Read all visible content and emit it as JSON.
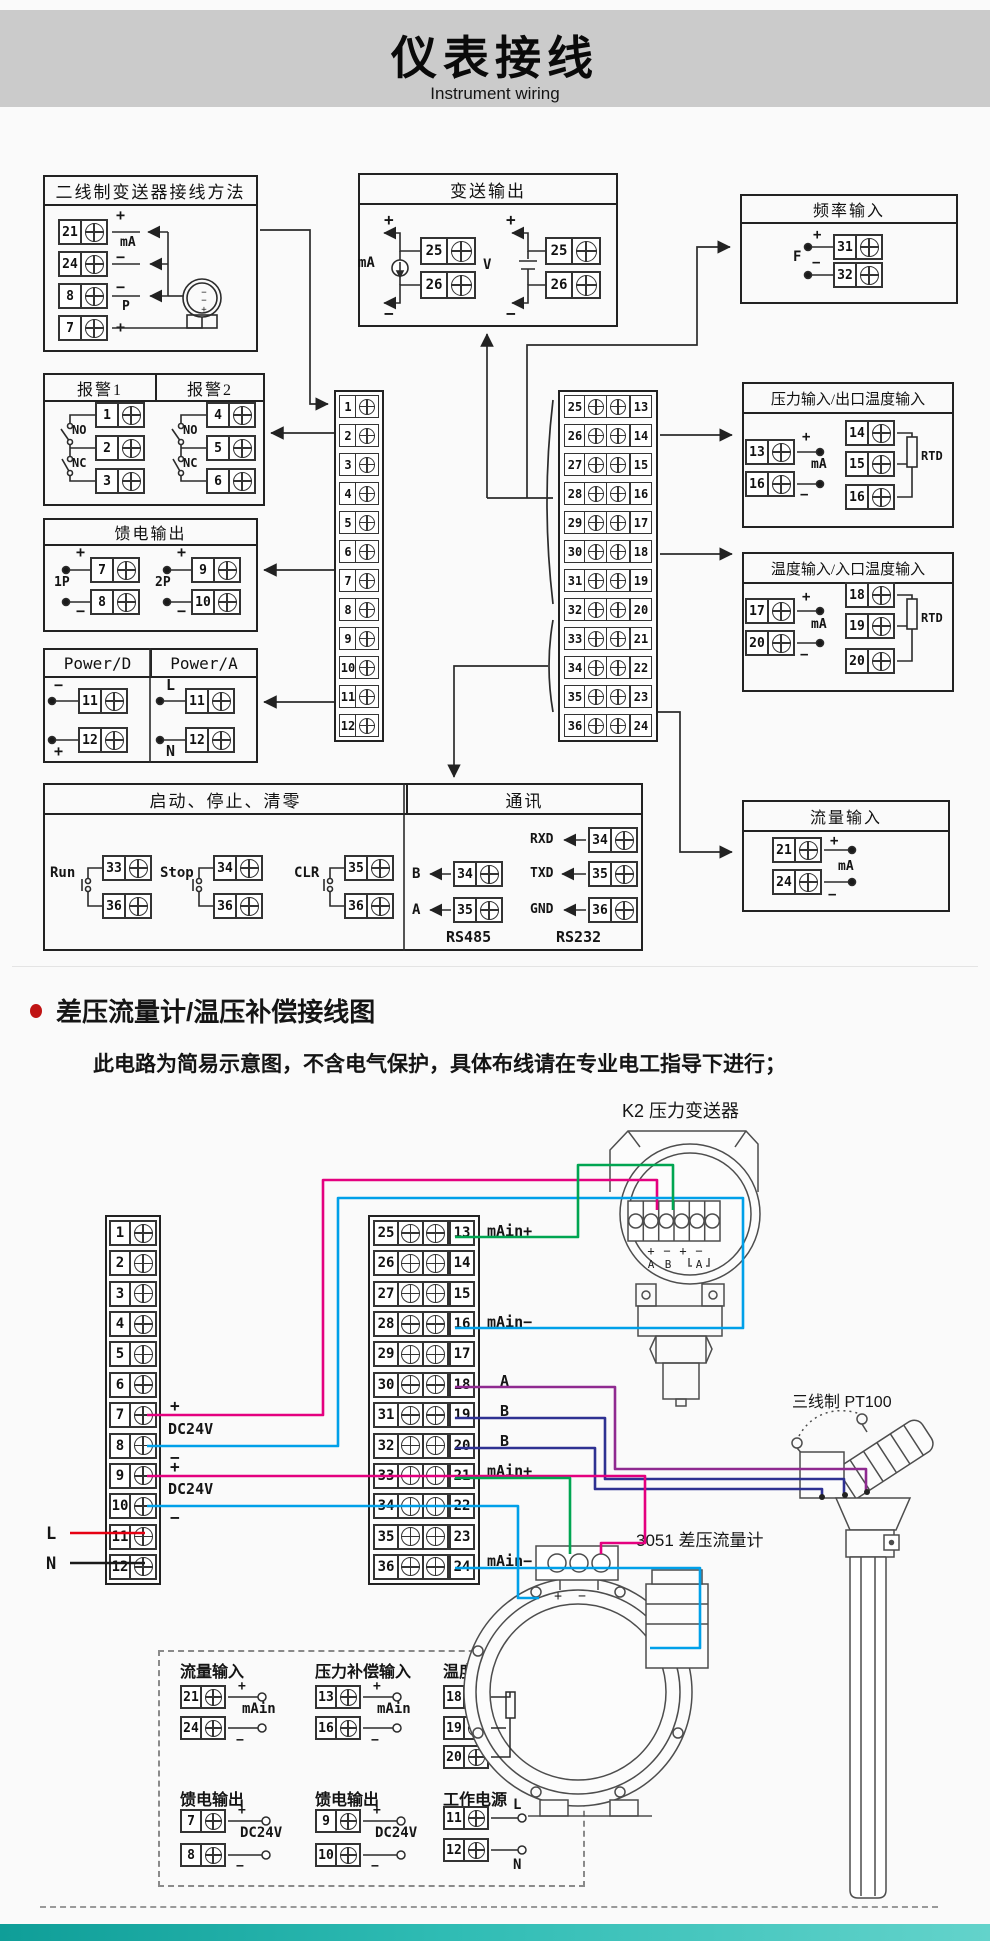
{
  "header": {
    "title": "仪表接线",
    "subtitle": "Instrument wiring"
  },
  "colors": {
    "header_band": "#cbcbcb",
    "line": "#2b2b2b",
    "magenta": "#e4007f",
    "cyan": "#00a0e9",
    "green": "#00a551",
    "purple": "#8f2a90",
    "navy": "#2e3192",
    "red": "#e60012",
    "black_wire": "#1a1a1a",
    "teal_bar": "#2fbcb4"
  },
  "sym": {
    "plus": "+",
    "minus": "−",
    "ma": "mA",
    "p": "P",
    "v": "V",
    "f": "F",
    "rtd": "RTD",
    "no": "NO",
    "nc": "NC",
    "l": "L",
    "n": "N",
    "a": "A",
    "b": "B",
    "dc24v": "DC24V",
    "main": "mAin",
    "p1": "1P",
    "p2": "2P"
  },
  "io": {
    "main_p": "mAin+",
    "main_m": "mAin−"
  },
  "section1": {
    "two_wire": {
      "title": "二线制变送器接线方法",
      "nums": [
        "21",
        "24",
        "8",
        "7"
      ]
    },
    "alarm1": {
      "title": "报警1",
      "nums": [
        "1",
        "2",
        "3"
      ]
    },
    "alarm2": {
      "title": "报警2",
      "nums": [
        "4",
        "5",
        "6"
      ]
    },
    "feed": {
      "title": "馈电输出",
      "nums": [
        "7",
        "8",
        "9",
        "10"
      ]
    },
    "power_d": {
      "title": "Power/D",
      "nums": [
        "11",
        "12"
      ]
    },
    "power_a": {
      "title": "Power/A",
      "nums": [
        "11",
        "12"
      ]
    },
    "transmit": {
      "title": "变送输出",
      "ma": [
        "25",
        "26"
      ],
      "v": [
        "25",
        "26"
      ]
    },
    "freq": {
      "title": "频率输入",
      "nums": [
        "31",
        "32"
      ]
    },
    "pressure": {
      "title": "压力输入/出口温度输入",
      "left": [
        "13",
        "16"
      ],
      "right": [
        "14",
        "15",
        "16"
      ]
    },
    "temp": {
      "title": "温度输入/入口温度输入",
      "left": [
        "17",
        "20"
      ],
      "right": [
        "18",
        "19",
        "20"
      ]
    },
    "flow": {
      "title": "流量输入",
      "nums": [
        "21",
        "24"
      ]
    },
    "runstop": {
      "title": "启动、停止、清零",
      "sw": [
        {
          "label": "Run",
          "a": "33",
          "b": "36"
        },
        {
          "label": "Stop",
          "a": "34",
          "b": "36"
        },
        {
          "label": "CLR",
          "a": "35",
          "b": "36"
        }
      ]
    },
    "comm": {
      "title": "通讯",
      "rs485": {
        "caption": "RS485",
        "rows": [
          {
            "sig": "B",
            "num": "34"
          },
          {
            "sig": "A",
            "num": "35"
          }
        ]
      },
      "rs232": {
        "caption": "RS232",
        "rows": [
          {
            "sig": "RXD",
            "num": "34"
          },
          {
            "sig": "TXD",
            "num": "35"
          },
          {
            "sig": "GND",
            "num": "36"
          }
        ]
      }
    },
    "strip_left": [
      "1",
      "2",
      "3",
      "4",
      "5",
      "6",
      "7",
      "8",
      "9",
      "10",
      "11",
      "12"
    ],
    "strip_right": [
      {
        "l": "25",
        "r": "13"
      },
      {
        "l": "26",
        "r": "14"
      },
      {
        "l": "27",
        "r": "15"
      },
      {
        "l": "28",
        "r": "16"
      },
      {
        "l": "29",
        "r": "17"
      },
      {
        "l": "30",
        "r": "18"
      },
      {
        "l": "31",
        "r": "19"
      },
      {
        "l": "32",
        "r": "20"
      },
      {
        "l": "33",
        "r": "21"
      },
      {
        "l": "34",
        "r": "22"
      },
      {
        "l": "35",
        "r": "23"
      },
      {
        "l": "36",
        "r": "24"
      }
    ]
  },
  "section2": {
    "heading": "差压流量计/温压补偿接线图",
    "note": "此电路为简易示意图，不含电气保护，具体布线请在专业电工指导下进行；",
    "k2": {
      "label": "K2 压力变送器"
    },
    "pt100": {
      "label": "三线制 PT100"
    },
    "d3051": {
      "label": "3051 差压流量计"
    },
    "dashed": {
      "g1": {
        "title": "流量输入",
        "n1": "21",
        "n2": "24"
      },
      "g2": {
        "title": "压力补偿输入",
        "n1": "13",
        "n2": "16"
      },
      "g3": {
        "title": "温度补偿输入",
        "n1": "18",
        "n2": "19",
        "n3": "20"
      },
      "g4": {
        "title": "馈电输出",
        "n1": "7",
        "n2": "8"
      },
      "g5": {
        "title": "馈电输出",
        "n1": "9",
        "n2": "10"
      },
      "g6": {
        "title": "工作电源",
        "n1": "11",
        "n2": "12"
      }
    }
  }
}
